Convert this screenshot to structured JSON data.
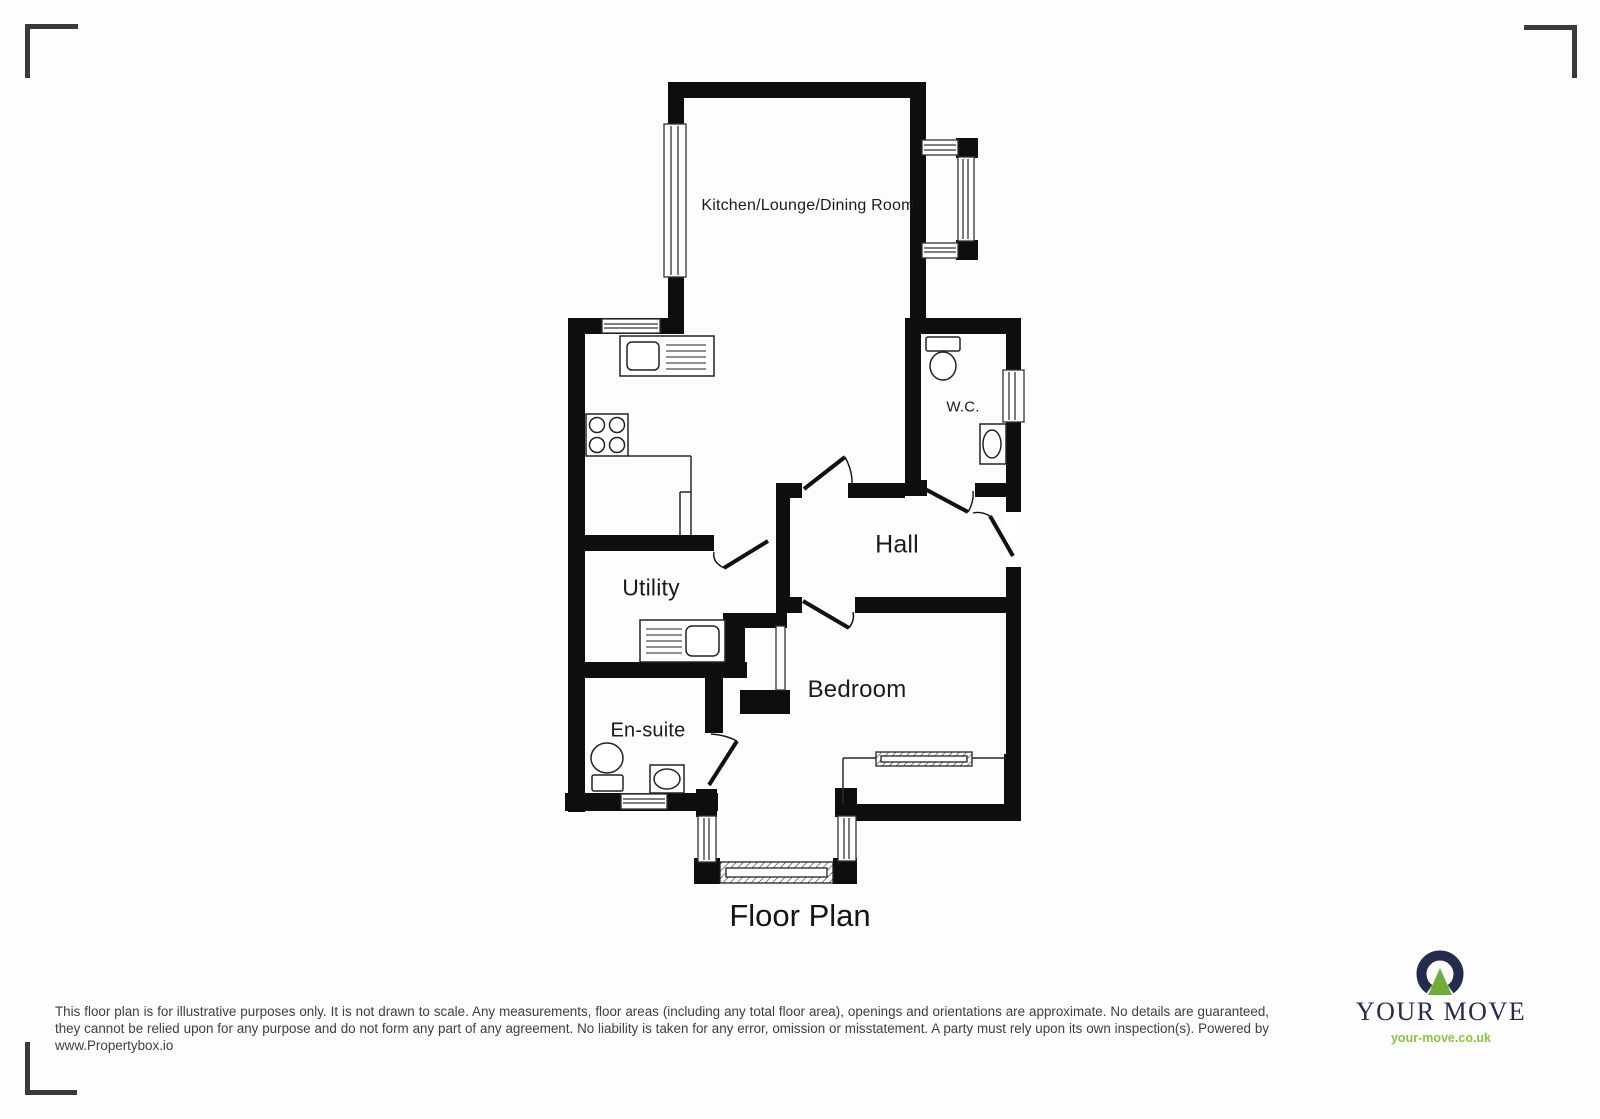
{
  "title": "Floor Plan",
  "rooms": {
    "kitchen": "Kitchen/Lounge/Dining Room",
    "wc": "W.C.",
    "hall": "Hall",
    "utility": "Utility",
    "bedroom": "Bedroom",
    "ensuite": "En-suite"
  },
  "footer": {
    "disclaimer": "This floor plan is for illustrative purposes only. It is not drawn to scale. Any measurements, floor areas (including any total floor area), openings and orientations are approximate. No details are guaranteed, they cannot be relied upon for any purpose and do not form any part of any agreement. No liability is taken for any error, omission or misstatement. A party must rely upon its own inspection(s). Powered by www.Propertybox.io"
  },
  "logo": {
    "brand": "YOUR MOVE",
    "website": "your-move.co.uk"
  },
  "icons": {
    "toilet": "oval bowl with cistern rectangle",
    "washbasin": "oval in rectangle",
    "hob": "square with four rings",
    "sink-drainer": "counter with sink and drainer lines",
    "door": "leaf line with quarter-circle swing arc",
    "window": "white strip with mullion lines"
  },
  "colors": {
    "background": "#fdfdfd",
    "wall": "#0e0e0e",
    "line": "#222222",
    "label_text": "#1b1b1b",
    "footer_text": "#3e3e3e",
    "corner_mark": "#3a3a3e",
    "logo_navy": "#262a4d",
    "logo_green": "#70ad3c",
    "logo_link_green": "#8cc444"
  }
}
